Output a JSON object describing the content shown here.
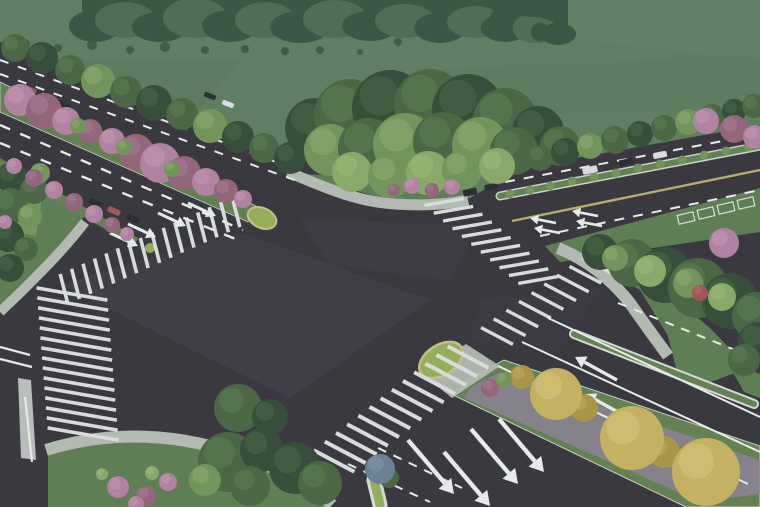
{
  "meta": {
    "title": "aerial-rendering-of-road-intersection",
    "width": 760,
    "height": 507
  },
  "palette": {
    "field": "#5c7a5e",
    "fieldDark": "#4f6b52",
    "forest": "#35503d",
    "forestLight": "#4a6850",
    "asphalt": "#333039",
    "stripe": "#d9dedc",
    "line": "#e8edeb",
    "yellow": "#b5ad69",
    "sidewalk": "#b2b9b1",
    "grass": "#5b7a4f",
    "grassLight": "#6f8d55",
    "island": "#94ad53",
    "curb": "#c9bb8c",
    "median": "#5f7d4d",
    "purple": "#8d7f9e",
    "tree": "#44613f",
    "treeDark": "#2f4734",
    "treeLight": "#6f9156",
    "treePale": "#86a765",
    "pink": "#b07fa2",
    "pinkDark": "#916079",
    "yellowTree": "#c5b05c",
    "yellowTreeDark": "#a8923f",
    "red": "#9e4f55",
    "carDark": "#23272e",
    "carWhite": "#d9dee1",
    "blueTree": "#667e93",
    "tan": "#b3a379",
    "haze": "#c2cabe"
  },
  "highlights": {
    "tree": "#5a7a4e",
    "treeDark": "#44603f",
    "treeLight": "#8aab6b",
    "treePale": "#9cbb78",
    "pink": "#c598b5",
    "pinkDark": "#a87a93",
    "yellowTree": "#d9c87a",
    "yellowTreeDark": "#bfa85a",
    "forest": "#46604a",
    "forestLight": "#5a7458",
    "red": "#b06a6e",
    "blueTree": "#8095a8",
    "island": "#a8c065",
    "grass": "#6b8a5c"
  },
  "field": {
    "mottles": [
      [
        "0,60 240,60 200,110 0,120",
        "#557257",
        0.5
      ],
      [
        "430,70 760,55 760,110 470,115",
        "#567458",
        0.5
      ],
      [
        "560,0 760,0 760,60 580,40",
        "#5f7d60",
        0.6
      ]
    ]
  },
  "forest": {
    "base": [
      82,
      0,
      486,
      30
    ],
    "bumps": [
      [
        95,
        26,
        26,
        16,
        "forest"
      ],
      [
        125,
        20,
        30,
        18,
        "forestLight"
      ],
      [
        160,
        27,
        28,
        15,
        "forest"
      ],
      [
        195,
        18,
        32,
        20,
        "forestLight"
      ],
      [
        230,
        26,
        28,
        16,
        "forest"
      ],
      [
        265,
        20,
        30,
        18,
        "forestLight"
      ],
      [
        300,
        27,
        30,
        16,
        "forest"
      ],
      [
        335,
        19,
        32,
        19,
        "forestLight"
      ],
      [
        370,
        26,
        28,
        15,
        "forest"
      ],
      [
        405,
        21,
        30,
        17,
        "forestLight"
      ],
      [
        440,
        28,
        26,
        15,
        "forest"
      ],
      [
        475,
        22,
        28,
        16,
        "forestLight"
      ],
      [
        505,
        28,
        24,
        14,
        "forest"
      ],
      [
        535,
        30,
        22,
        13,
        "forestLight"
      ],
      [
        558,
        34,
        18,
        11,
        "forest"
      ]
    ],
    "sparse": [
      [
        25,
        44,
        5
      ],
      [
        58,
        48,
        4
      ],
      [
        92,
        45,
        5
      ],
      [
        130,
        50,
        4
      ],
      [
        165,
        47,
        5
      ],
      [
        205,
        50,
        4
      ],
      [
        245,
        49,
        4
      ],
      [
        285,
        51,
        4
      ],
      [
        320,
        50,
        4
      ],
      [
        360,
        52,
        3
      ],
      [
        398,
        42,
        4
      ]
    ],
    "cluster": [
      [
        505,
        22,
        16,
        "forest"
      ],
      [
        525,
        28,
        12,
        "forestLight"
      ],
      [
        540,
        32,
        9,
        "forest"
      ]
    ]
  },
  "asphalt": {
    "poly": "0,42 310,162 360,192 400,203 440,203 470,198 520,168 760,125 760,507 0,507",
    "sheens": [
      [
        "60,285 240,232 430,300 290,398",
        "#413d49",
        0.45
      ],
      [
        "300,220 480,225 450,280 330,265",
        "#443f4b",
        0.3
      ],
      [
        "90,430 260,450 240,507 60,500",
        "#2b2931",
        0.5
      ],
      [
        "480,300 600,290 560,350 470,340",
        "#3a3642",
        0.35
      ]
    ]
  },
  "grass_areas": [
    [
      "0,168 55,190 88,212 60,248 30,278 8,298 0,306",
      "grass"
    ],
    [
      "48,452 120,438 205,444 268,468 312,492 332,507 48,507",
      "grass"
    ],
    [
      "300,174 350,190 420,200 462,194 420,186 352,176",
      "grass"
    ],
    [
      "558,242 640,290 668,336 676,368 700,386 748,368 712,330 668,292 612,258",
      "grass"
    ],
    [
      "545,246 760,188 760,232 560,262",
      "grass"
    ],
    [
      "726,360 760,374 760,398 744,392",
      "grass"
    ]
  ],
  "extras": [
    [
      "18,378 31,380 36,460 21,458",
      "#c8cdca",
      0.9
    ],
    [
      "0,186 42,198 36,236 0,228",
      "#74925b",
      1
    ],
    [
      "4,200 22,205 19,221 1,217",
      "#b3a379",
      1
    ]
  ],
  "arcs": [
    [
      "M288,172 C330,190 360,202 395,204 C425,206 450,204 468,200",
      11
    ],
    [
      "M85,222 C65,248 45,268 25,288 C15,298 6,306 0,312",
      10
    ],
    [
      "M46,450 C110,430 180,432 248,458 C285,472 315,488 332,505",
      12
    ],
    [
      "M558,248 C592,262 615,284 630,303 C645,325 658,342 668,356",
      12
    ]
  ],
  "medians": {
    "nwA": {
      "poly": "0,82 0,112 248,222 256,206",
      "teardrop": [
        262,
        218,
        15,
        10,
        24
      ]
    },
    "nwB": {
      "poly": "0,158 0,168 134,246 138,238",
      "tip": [
        150,
        248,
        5
      ]
    },
    "hedge": {
      "x1": 500,
      "y1": 196,
      "x2": 760,
      "y2": 146,
      "bushes": [
        [
          510,
          194
        ],
        [
          530,
          190
        ],
        [
          550,
          186
        ],
        [
          572,
          181
        ],
        [
          594,
          177
        ],
        [
          616,
          173
        ],
        [
          638,
          168
        ],
        [
          660,
          164
        ],
        [
          682,
          160
        ],
        [
          704,
          155
        ],
        [
          726,
          151
        ],
        [
          748,
          147
        ]
      ]
    },
    "se": {
      "poly": "468,380 504,360 760,446 760,507 686,507 455,396",
      "purple": "470,388 500,372 760,460 760,494 700,502 464,398"
    },
    "thin": [
      574,
      334,
      754,
      404
    ],
    "refuge": {
      "poly": "420,372 466,344 500,366 452,398",
      "dome": [
        441,
        360,
        24,
        15,
        -33
      ]
    },
    "small_island": [
      374,
      480,
      380,
      505
    ]
  },
  "crosswalks": [
    {
      "a": [
        236,
        212
      ],
      "b": [
        64,
        289
      ],
      "dir": [
        0.25,
        0.97
      ],
      "len": 31,
      "n": 16,
      "thick": 3.6
    },
    {
      "a": [
        72,
        294
      ],
      "b": [
        83,
        434
      ],
      "dir": [
        0.985,
        0.17
      ],
      "len": 72,
      "n": 15,
      "thick": 3.6
    },
    {
      "a": [
        444,
        202
      ],
      "b": [
        538,
        280
      ],
      "dir": [
        0.985,
        -0.17
      ],
      "len": 40,
      "n": 11,
      "thick": 3.4
    },
    {
      "a": [
        334,
        461
      ],
      "b": [
        468,
        357
      ],
      "dir": [
        0.885,
        0.466
      ],
      "len": 46,
      "n": 13,
      "thick": 4
    },
    {
      "a": [
        497,
        336
      ],
      "b": [
        598,
        266
      ],
      "dir": [
        0.885,
        0.466
      ],
      "len": 36,
      "n": 9,
      "thick": 3.4
    }
  ],
  "lines": [
    [
      0,
      60,
      298,
      170,
      2,
      "line",
      "9 10"
    ],
    [
      0,
      74,
      300,
      182,
      2,
      "line",
      "9 10"
    ],
    [
      0,
      125,
      243,
      230,
      2.4,
      "line",
      "11 11"
    ],
    [
      0,
      143,
      238,
      240,
      2.4,
      "line",
      "11 11"
    ],
    [
      505,
      182,
      760,
      134,
      2,
      "line",
      "10 9"
    ],
    [
      540,
      236,
      760,
      190,
      2,
      "line",
      "10 9"
    ],
    [
      512,
      221,
      760,
      170,
      2.4,
      "yellow",
      null
    ],
    [
      548,
      318,
      760,
      417,
      2,
      "line",
      null
    ],
    [
      522,
      342,
      760,
      452,
      2,
      "line",
      null
    ],
    [
      498,
      366,
      748,
      484,
      2,
      "line",
      null
    ],
    [
      618,
      303,
      760,
      360,
      2,
      "line",
      "9 8"
    ],
    [
      348,
      464,
      430,
      502,
      2,
      "line",
      "9 8"
    ],
    [
      378,
      448,
      462,
      488,
      2,
      "line",
      "9 8"
    ],
    [
      0,
      347,
      30,
      355,
      2.2,
      "line",
      null
    ],
    [
      0,
      359,
      32,
      367,
      2.2,
      "line",
      null
    ],
    [
      25,
      397,
      32,
      462,
      2.2,
      "line",
      null
    ]
  ],
  "arrows": [
    [
      128,
      224,
      156,
      237,
      3
    ],
    [
      158,
      213,
      186,
      226,
      3
    ],
    [
      188,
      203,
      216,
      216,
      3
    ],
    [
      110,
      233,
      138,
      246,
      3
    ],
    [
      556,
      223,
      530,
      218,
      2.6
    ],
    [
      560,
      233,
      534,
      228,
      2.6
    ],
    [
      598,
      216,
      572,
      211,
      2.6
    ],
    [
      602,
      226,
      576,
      221,
      2.6
    ],
    [
      617,
      380,
      575,
      357,
      3.4
    ],
    [
      627,
      417,
      585,
      394,
      3.4
    ],
    [
      673,
      465,
      631,
      442,
      3.8
    ],
    [
      728,
      484,
      686,
      461,
      3.8
    ],
    [
      408,
      440,
      454,
      494,
      4.4
    ],
    [
      444,
      452,
      490,
      506,
      4.4
    ],
    [
      471,
      429,
      518,
      484,
      4.4
    ],
    [
      499,
      419,
      544,
      472,
      4.4
    ]
  ],
  "cars": [
    [
      30,
      90,
      13,
      6,
      23,
      "red"
    ],
    [
      47,
      97,
      12,
      5,
      23,
      "carWhite"
    ],
    [
      64,
      105,
      12,
      5,
      23,
      "carDark"
    ],
    [
      95,
      203,
      13,
      6,
      23,
      "carDark"
    ],
    [
      114,
      211,
      13,
      6,
      23,
      "red"
    ],
    [
      133,
      219,
      13,
      6,
      23,
      "carDark"
    ],
    [
      210,
      96,
      12,
      5,
      21,
      "carDark"
    ],
    [
      228,
      104,
      12,
      5,
      21,
      "carWhite"
    ],
    [
      470,
      192,
      14,
      7,
      -10,
      "carDark"
    ],
    [
      491,
      187,
      13,
      6,
      -10,
      "carDark"
    ],
    [
      590,
      170,
      15,
      7,
      -11,
      "carWhite"
    ],
    [
      626,
      162,
      14,
      6,
      -11,
      "carDark"
    ],
    [
      660,
      155,
      14,
      6,
      -11,
      "carWhite"
    ]
  ],
  "stalls": [
    [
      686,
      218,
      16,
      9,
      -13
    ],
    [
      706,
      213,
      16,
      9,
      -13
    ],
    [
      726,
      208,
      16,
      9,
      -13
    ],
    [
      746,
      203,
      16,
      9,
      -13
    ]
  ],
  "trees": [
    [
      15,
      48,
      14,
      "tree"
    ],
    [
      42,
      58,
      16,
      "treeDark"
    ],
    [
      70,
      70,
      15,
      "tree"
    ],
    [
      98,
      81,
      17,
      "treeLight"
    ],
    [
      126,
      92,
      16,
      "tree"
    ],
    [
      154,
      103,
      18,
      "treeDark"
    ],
    [
      182,
      114,
      16,
      "tree"
    ],
    [
      210,
      126,
      17,
      "treeLight"
    ],
    [
      238,
      137,
      16,
      "treeDark"
    ],
    [
      264,
      148,
      15,
      "tree"
    ],
    [
      290,
      158,
      16,
      "treeDark"
    ],
    [
      315,
      128,
      30,
      "treeDark"
    ],
    [
      350,
      115,
      36,
      "tree"
    ],
    [
      390,
      108,
      38,
      "treeDark"
    ],
    [
      430,
      105,
      36,
      "tree"
    ],
    [
      468,
      110,
      36,
      "treeDark"
    ],
    [
      505,
      120,
      32,
      "tree"
    ],
    [
      538,
      132,
      26,
      "treeDark"
    ],
    [
      560,
      146,
      20,
      "tree"
    ],
    [
      330,
      150,
      26,
      "treeLight"
    ],
    [
      368,
      148,
      30,
      "tree"
    ],
    [
      405,
      145,
      32,
      "treeLight"
    ],
    [
      443,
      142,
      30,
      "tree"
    ],
    [
      480,
      145,
      28,
      "treeLight"
    ],
    [
      514,
      151,
      24,
      "tree"
    ],
    [
      352,
      172,
      20,
      "treePale"
    ],
    [
      390,
      176,
      22,
      "treeLight"
    ],
    [
      428,
      173,
      22,
      "treePale"
    ],
    [
      462,
      170,
      20,
      "treeLight"
    ],
    [
      497,
      166,
      18,
      "treePale"
    ],
    [
      412,
      186,
      8,
      "pink"
    ],
    [
      432,
      190,
      7,
      "pinkDark"
    ],
    [
      452,
      187,
      8,
      "pink"
    ],
    [
      394,
      190,
      6,
      "pinkDark"
    ],
    [
      540,
      158,
      13,
      "tree"
    ],
    [
      565,
      152,
      14,
      "treeDark"
    ],
    [
      590,
      146,
      13,
      "treeLight"
    ],
    [
      615,
      140,
      14,
      "tree"
    ],
    [
      640,
      134,
      13,
      "treeDark"
    ],
    [
      664,
      128,
      13,
      "tree"
    ],
    [
      688,
      122,
      13,
      "treeLight"
    ],
    [
      712,
      116,
      12,
      "tree"
    ],
    [
      734,
      111,
      12,
      "treeDark"
    ],
    [
      754,
      106,
      12,
      "tree"
    ],
    [
      706,
      121,
      13,
      "pink"
    ],
    [
      734,
      129,
      14,
      "pinkDark"
    ],
    [
      755,
      137,
      12,
      "pink"
    ],
    [
      600,
      252,
      18,
      "treeDark"
    ],
    [
      632,
      263,
      24,
      "tree"
    ],
    [
      665,
      275,
      28,
      "treeDark"
    ],
    [
      698,
      288,
      30,
      "tree"
    ],
    [
      730,
      301,
      28,
      "treeDark"
    ],
    [
      756,
      316,
      24,
      "tree"
    ],
    [
      758,
      342,
      20,
      "treeDark"
    ],
    [
      744,
      360,
      16,
      "tree"
    ],
    [
      615,
      258,
      13,
      "treeLight"
    ],
    [
      650,
      271,
      16,
      "treePale"
    ],
    [
      688,
      283,
      15,
      "treeLight"
    ],
    [
      722,
      297,
      14,
      "treePale"
    ],
    [
      724,
      243,
      15,
      "pink"
    ],
    [
      700,
      293,
      8,
      "red"
    ],
    [
      12,
      178,
      16,
      "treeDark"
    ],
    [
      34,
      190,
      14,
      "tree"
    ],
    [
      10,
      206,
      18,
      "tree"
    ],
    [
      30,
      216,
      12,
      "treeLight"
    ],
    [
      8,
      236,
      16,
      "treeDark"
    ],
    [
      26,
      249,
      12,
      "tree"
    ],
    [
      10,
      268,
      14,
      "treeDark"
    ],
    [
      40,
      173,
      10,
      "treeLight"
    ],
    [
      5,
      222,
      7,
      "pink"
    ],
    [
      20,
      100,
      16,
      "pink"
    ],
    [
      44,
      111,
      18,
      "pinkDark"
    ],
    [
      66,
      121,
      14,
      "pink"
    ],
    [
      90,
      131,
      12,
      "pinkDark"
    ],
    [
      112,
      141,
      13,
      "pink"
    ],
    [
      136,
      152,
      18,
      "pinkDark"
    ],
    [
      160,
      163,
      20,
      "pink"
    ],
    [
      184,
      173,
      17,
      "pinkDark"
    ],
    [
      206,
      182,
      14,
      "pink"
    ],
    [
      226,
      191,
      12,
      "pinkDark"
    ],
    [
      243,
      199,
      9,
      "pink"
    ],
    [
      78,
      126,
      8,
      "treeLight"
    ],
    [
      124,
      147,
      8,
      "treeLight"
    ],
    [
      172,
      169,
      8,
      "treeLight"
    ],
    [
      14,
      166,
      8,
      "pink"
    ],
    [
      34,
      178,
      9,
      "pinkDark"
    ],
    [
      54,
      190,
      9,
      "pink"
    ],
    [
      74,
      202,
      9,
      "pinkDark"
    ],
    [
      94,
      214,
      9,
      "pink"
    ],
    [
      112,
      225,
      8,
      "pinkDark"
    ],
    [
      127,
      234,
      7,
      "pink"
    ],
    [
      522,
      377,
      12,
      "yellowTreeDark"
    ],
    [
      584,
      408,
      14,
      "yellowTreeDark"
    ],
    [
      664,
      452,
      16,
      "yellowTreeDark"
    ],
    [
      556,
      394,
      26,
      "yellowTree"
    ],
    [
      632,
      438,
      32,
      "yellowTree"
    ],
    [
      706,
      472,
      34,
      "yellowTree"
    ],
    [
      490,
      388,
      9,
      "pinkDark"
    ],
    [
      504,
      380,
      8,
      "treeLight"
    ],
    [
      389,
      478,
      10,
      "tree"
    ],
    [
      380,
      469,
      15,
      "blueTree"
    ],
    [
      238,
      408,
      24,
      "tree"
    ],
    [
      270,
      417,
      18,
      "treeDark"
    ],
    [
      228,
      462,
      30,
      "tree"
    ],
    [
      262,
      450,
      22,
      "treeDark"
    ],
    [
      295,
      468,
      26,
      "treeDark"
    ],
    [
      320,
      483,
      22,
      "tree"
    ],
    [
      205,
      480,
      16,
      "treeLight"
    ],
    [
      250,
      486,
      20,
      "tree"
    ],
    [
      118,
      487,
      11,
      "pink"
    ],
    [
      146,
      496,
      10,
      "pinkDark"
    ],
    [
      168,
      482,
      9,
      "pink"
    ],
    [
      136,
      504,
      8,
      "pink"
    ],
    [
      152,
      473,
      7,
      "treePale"
    ],
    [
      102,
      474,
      6,
      "treePale"
    ]
  ],
  "haze": {
    "opacity": 0.06
  }
}
